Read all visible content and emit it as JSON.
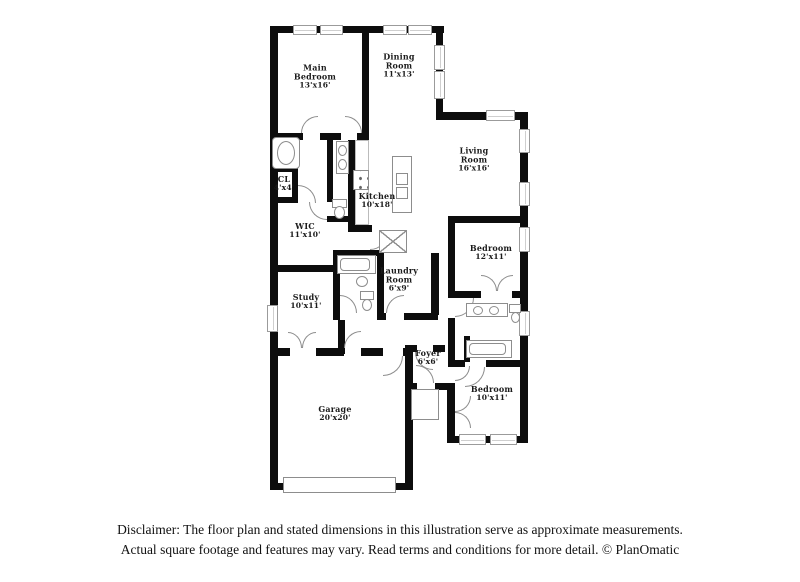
{
  "floorplan": {
    "rooms": [
      {
        "name": "Main Bedroom",
        "dims": "13'x16'"
      },
      {
        "name": "Dining Room",
        "dims": "11'x13'"
      },
      {
        "name": "Living Room",
        "dims": "16'x16'"
      },
      {
        "name": "CL",
        "dims": "4'x4'"
      },
      {
        "name": "WIC",
        "dims": "11'x10'"
      },
      {
        "name": "Kitchen",
        "dims": "10'x18'"
      },
      {
        "name": "Laundry Room",
        "dims": "6'x9'"
      },
      {
        "name": "Bedroom",
        "dims": "12'x11'"
      },
      {
        "name": "Study",
        "dims": "10'x11'"
      },
      {
        "name": "Foyer",
        "dims": "6'x6'"
      },
      {
        "name": "Bedroom",
        "dims": "10'x11'"
      },
      {
        "name": "Garage",
        "dims": "20'x20'"
      }
    ]
  },
  "disclaimer": {
    "line1": "Disclaimer: The floor plan and stated dimensions in this illustration serve as approximate measurements.",
    "line2": "Actual square footage and features may vary. Read terms and conditions for more detail. © PlanOmatic"
  },
  "colors": {
    "wall": "#0d0d0d",
    "fixture": "#8d8d8d",
    "text": "#1b1b1b"
  }
}
